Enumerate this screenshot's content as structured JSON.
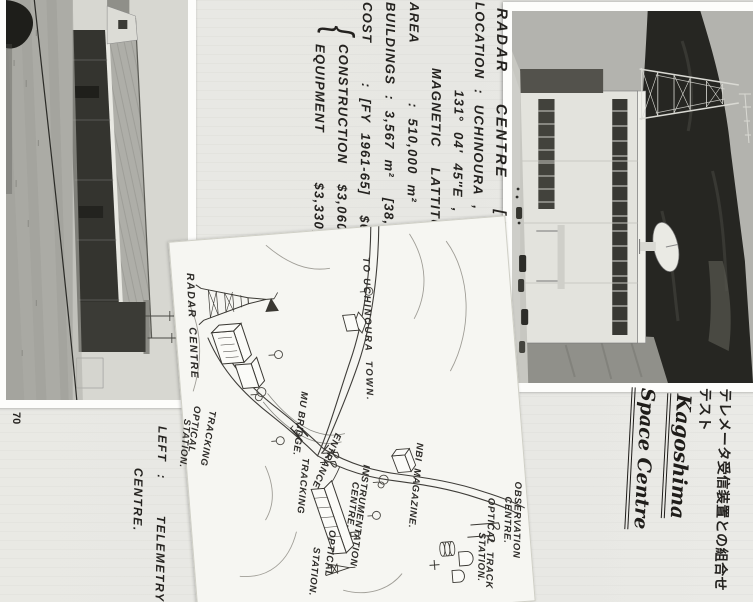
{
  "page_number": "70",
  "info": {
    "title": "RADAR  CENTRE  [AT MIYABARU].",
    "lines": [
      "LOCATION : UCHINOURA , KAGOSHIMA.",
      "131° 04′ 45″E ,  31° 15′ 00″N",
      "MAGNETIC  LATTITUDE  19.8°N.",
      "AREA      : 510,000 m²  (126 ACRES)",
      "BUILDINGS : 3,567 m²  [38,395 sq-ft]",
      "COST    : [FY 1961-65]  $6,390,000.",
      "CONSTRUCTION  $3,060,000.",
      "EQUIPMENT     $3,330,000."
    ],
    "cost_brace": "{"
  },
  "captions": {
    "japanese_note": "テレメータ受信装置との組合せテスト",
    "cursive_line1": "Kagoshima",
    "cursive_line2": "Space Centre",
    "photo2_line1": "LEFT :   TELEMETRY",
    "photo2_line2": "CENTRE."
  },
  "map": {
    "labels": {
      "radar_centre": "RADAR  CENTRE",
      "tracking1": "TRACKING",
      "optical1": "OPTICAL",
      "station1": "STATION.",
      "to_town": "TO UCHINOURA  TOWN.",
      "mu_bridge": "MU BRIDGE.",
      "entrance": "ENTRANCE",
      "nbi": "NBI  MAGAZINE.",
      "instr1": "INSTRUMENTATION",
      "instr2": "CENTRE.",
      "optical2": "OPTICAL",
      "tracking2": "TRACKING",
      "station2": "STATION.",
      "obs1": "OBSERVATION",
      "obs2": "CENTRE.",
      "otrack1": "OPTICAL  TRACK",
      "otrack2": "STATION."
    }
  }
}
